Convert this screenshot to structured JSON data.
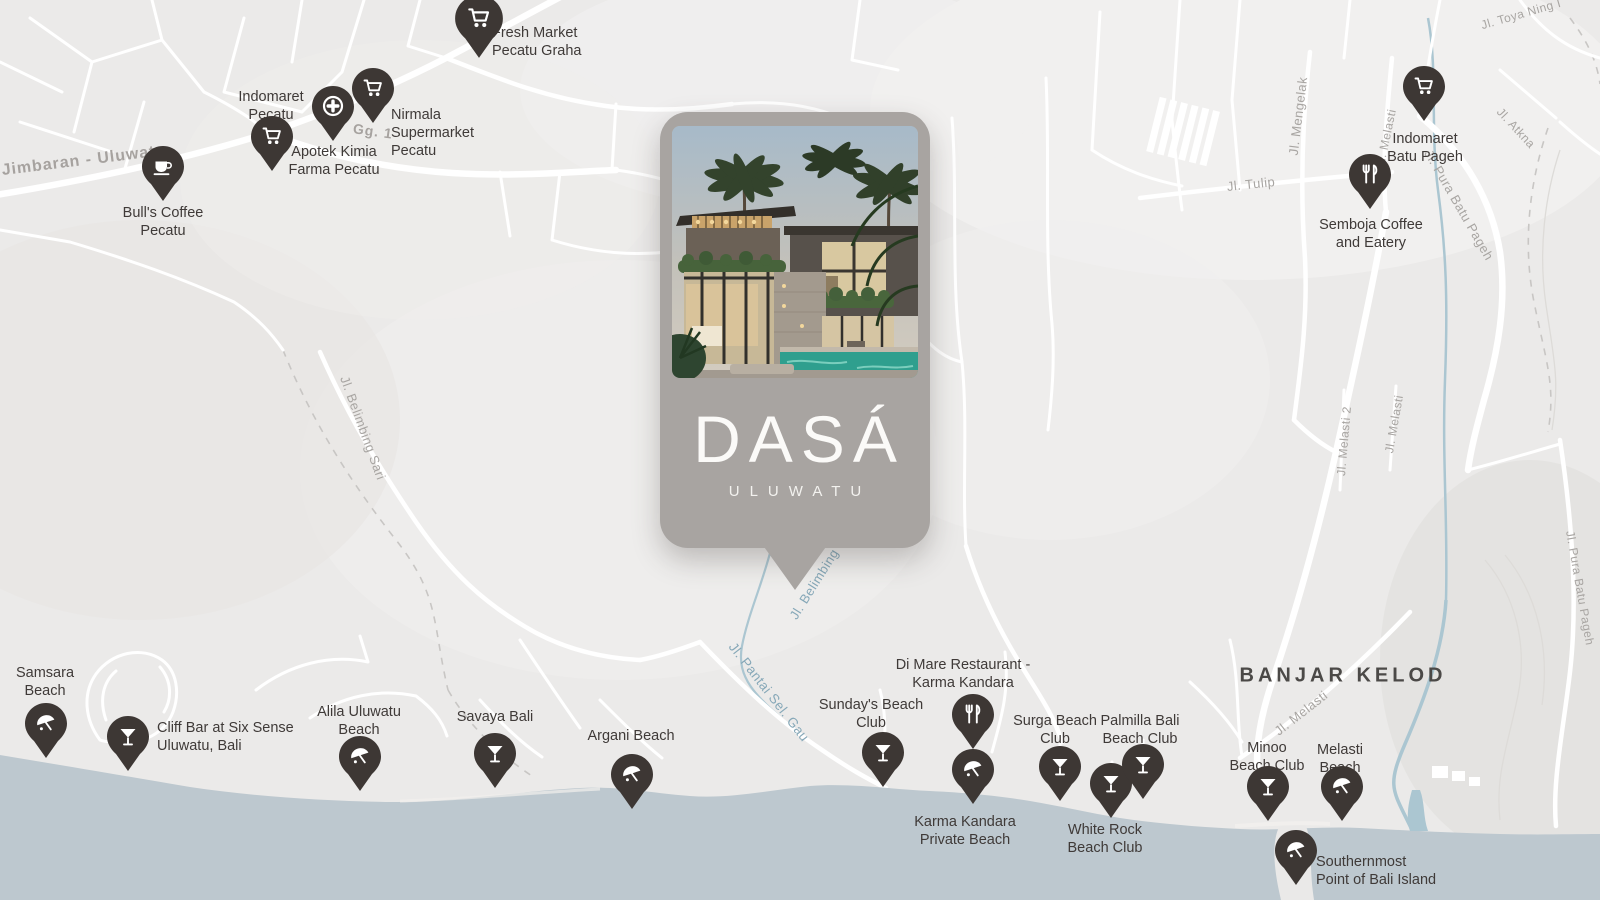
{
  "card": {
    "brand": "DASÁ",
    "subtitle": "ULUWATU"
  },
  "map": {
    "area_label": {
      "text": "BANJAR KELOD"
    },
    "colors": {
      "land": "#ebeae9",
      "ocean": "#bdc8cf",
      "road": "#ffffff",
      "pin": "#3d3734",
      "poi_text": "#3f3a38",
      "road_label": "#a8a5a2",
      "water_label": "#86a8b8",
      "area_label": "#4b4947",
      "card_bg": "#a8a4a1",
      "pool": "#2f9f8e"
    },
    "pois": [
      {
        "id": "fresh-market-pecatu-graha",
        "icon": "cart",
        "big": true,
        "pin": {
          "x": 479,
          "y": 57
        },
        "label": {
          "lines": [
            "Fresh Market",
            "Pecatu Graha"
          ],
          "x": 492,
          "y": 24,
          "align": "left"
        }
      },
      {
        "id": "indomaret-pecatu",
        "icon": "cart",
        "pin": {
          "x": 272,
          "y": 170
        },
        "label": {
          "lines": [
            "Indomaret",
            "Pecatu"
          ],
          "x": 271,
          "y": 88,
          "align": "center"
        }
      },
      {
        "id": "apotek-kimia-farma-pecatu",
        "icon": "pharmacy",
        "pin": {
          "x": 333,
          "y": 140
        },
        "label": {
          "lines": [
            "Apotek Kimia",
            "Farma Pecatu"
          ],
          "x": 334,
          "y": 143,
          "align": "center"
        }
      },
      {
        "id": "nirmala-supermarket-pecatu",
        "icon": "cart",
        "pin": {
          "x": 373,
          "y": 122
        },
        "label": {
          "lines": [
            "Nirmala",
            "Supermarket",
            "Pecatu"
          ],
          "x": 391,
          "y": 106,
          "align": "left"
        }
      },
      {
        "id": "bulls-coffee-pecatu",
        "icon": "coffee",
        "pin": {
          "x": 163,
          "y": 200
        },
        "label": {
          "lines": [
            "Bull's Coffee",
            "Pecatu"
          ],
          "x": 163,
          "y": 204,
          "align": "center"
        }
      },
      {
        "id": "indomaret-batu-pageh",
        "icon": "cart",
        "pin": {
          "x": 1424,
          "y": 120
        },
        "label": {
          "lines": [
            "Indomaret",
            "Batu Pageh"
          ],
          "x": 1425,
          "y": 130,
          "align": "center"
        }
      },
      {
        "id": "semboja-coffee-and-eatery",
        "icon": "restaurant",
        "pin": {
          "x": 1370,
          "y": 208
        },
        "label": {
          "lines": [
            "Semboja Coffee",
            "and Eatery"
          ],
          "x": 1371,
          "y": 216,
          "align": "center"
        }
      },
      {
        "id": "samsara-beach",
        "icon": "umbrella",
        "pin": {
          "x": 46,
          "y": 757
        },
        "label": {
          "lines": [
            "Samsara",
            "Beach"
          ],
          "x": 45,
          "y": 664,
          "align": "center"
        }
      },
      {
        "id": "cliff-bar-six-sense",
        "icon": "cocktail",
        "pin": {
          "x": 128,
          "y": 770
        },
        "label": {
          "lines": [
            "Cliff Bar at Six Sense",
            "Uluwatu, Bali"
          ],
          "x": 157,
          "y": 719,
          "align": "left"
        }
      },
      {
        "id": "alila-uluwatu-beach",
        "icon": "umbrella",
        "pin": {
          "x": 360,
          "y": 790
        },
        "label": {
          "lines": [
            "Alila Uluwatu",
            "Beach"
          ],
          "x": 359,
          "y": 703,
          "align": "center"
        }
      },
      {
        "id": "savaya-bali",
        "icon": "cocktail",
        "pin": {
          "x": 495,
          "y": 787
        },
        "label": {
          "lines": [
            "Savaya Bali"
          ],
          "x": 495,
          "y": 708,
          "align": "center"
        }
      },
      {
        "id": "argani-beach",
        "icon": "umbrella",
        "pin": {
          "x": 632,
          "y": 808
        },
        "label": {
          "lines": [
            "Argani Beach"
          ],
          "x": 631,
          "y": 727,
          "align": "center"
        }
      },
      {
        "id": "sundays-beach-club",
        "icon": "cocktail",
        "pin": {
          "x": 883,
          "y": 786
        },
        "label": {
          "lines": [
            "Sunday's Beach",
            "Club"
          ],
          "x": 871,
          "y": 696,
          "align": "center"
        }
      },
      {
        "id": "di-mare-restaurant-karma-kandara",
        "icon": "restaurant",
        "pin": {
          "x": 973,
          "y": 748
        },
        "label": {
          "lines": [
            "Di Mare Restaurant -",
            "Karma Kandara"
          ],
          "x": 963,
          "y": 656,
          "align": "center"
        }
      },
      {
        "id": "karma-kandara-private-beach",
        "icon": "umbrella",
        "pin": {
          "x": 973,
          "y": 803
        },
        "label": {
          "lines": [
            "Karma Kandara",
            "Private Beach"
          ],
          "x": 965,
          "y": 813,
          "align": "center"
        }
      },
      {
        "id": "surga-beach-club",
        "icon": "cocktail",
        "pin": {
          "x": 1060,
          "y": 800
        },
        "label": {
          "lines": [
            "Surga Beach",
            "Club"
          ],
          "x": 1055,
          "y": 712,
          "align": "center"
        }
      },
      {
        "id": "white-rock-beach-club",
        "icon": "cocktail",
        "pin": {
          "x": 1111,
          "y": 817
        },
        "label": {
          "lines": [
            "White Rock",
            "Beach Club"
          ],
          "x": 1105,
          "y": 821,
          "align": "center"
        }
      },
      {
        "id": "palmilla-bali-beach-club",
        "icon": "cocktail",
        "pin": {
          "x": 1143,
          "y": 798
        },
        "label": {
          "lines": [
            "Palmilla Bali",
            "Beach Club"
          ],
          "x": 1140,
          "y": 712,
          "align": "center"
        }
      },
      {
        "id": "minoo-beach-club",
        "icon": "cocktail",
        "pin": {
          "x": 1268,
          "y": 820
        },
        "label": {
          "lines": [
            "Minoo",
            "Beach Club"
          ],
          "x": 1267,
          "y": 739,
          "align": "center"
        }
      },
      {
        "id": "melasti-beach",
        "icon": "umbrella",
        "pin": {
          "x": 1342,
          "y": 820
        },
        "label": {
          "lines": [
            "Melasti",
            "Beach"
          ],
          "x": 1340,
          "y": 741,
          "align": "center"
        }
      },
      {
        "id": "southernmost-point",
        "icon": "umbrella",
        "pin": {
          "x": 1296,
          "y": 884
        },
        "label": {
          "lines": [
            "Southernmost",
            "Point of Bali Island"
          ],
          "x": 1316,
          "y": 853,
          "align": "left"
        }
      }
    ],
    "road_labels": [
      {
        "text": "Jimbaran - Uluwatu",
        "x": 84,
        "y": 161,
        "rot": -7,
        "size": 16,
        "cls": "bold"
      },
      {
        "text": "Gg. 1",
        "x": 373,
        "y": 131,
        "rot": 8,
        "size": 14,
        "cls": "bold"
      },
      {
        "text": "Jl. Toya Ning I",
        "x": 1521,
        "y": 14,
        "rot": -16,
        "size": 12,
        "cls": ""
      },
      {
        "text": "Jl. Mengelak",
        "x": 1298,
        "y": 116,
        "rot": -83,
        "size": 13,
        "cls": ""
      },
      {
        "text": "Jl. Melasti",
        "x": 1386,
        "y": 138,
        "rot": -78,
        "size": 12,
        "cls": ""
      },
      {
        "text": "Jl. Atkna",
        "x": 1516,
        "y": 128,
        "rot": 47,
        "size": 12,
        "cls": ""
      },
      {
        "text": "Jl. Tulip",
        "x": 1251,
        "y": 184,
        "rot": -6,
        "size": 13,
        "cls": ""
      },
      {
        "text": "Jl. Pura Batu Pageh",
        "x": 1459,
        "y": 205,
        "rot": 60,
        "size": 13,
        "cls": ""
      },
      {
        "text": "Jl. Melasti 2",
        "x": 1344,
        "y": 441,
        "rot": -85,
        "size": 12,
        "cls": ""
      },
      {
        "text": "Jl. Melasti",
        "x": 1394,
        "y": 424,
        "rot": -80,
        "size": 12,
        "cls": ""
      },
      {
        "text": "Jl. Pura Batu Pageh",
        "x": 1580,
        "y": 588,
        "rot": 80,
        "size": 12,
        "cls": ""
      },
      {
        "text": "Jl. Belimbing Sari",
        "x": 363,
        "y": 428,
        "rot": 70,
        "size": 13,
        "cls": ""
      },
      {
        "text": "Jl. Belimbing",
        "x": 814,
        "y": 584,
        "rot": -58,
        "size": 13,
        "cls": "water"
      },
      {
        "text": "Jl. Pantai Sel. Gau",
        "x": 769,
        "y": 692,
        "rot": 52,
        "size": 13.5,
        "cls": "water"
      },
      {
        "text": "Jl. Melasti",
        "x": 1301,
        "y": 713,
        "rot": -38,
        "size": 13,
        "cls": ""
      }
    ]
  }
}
